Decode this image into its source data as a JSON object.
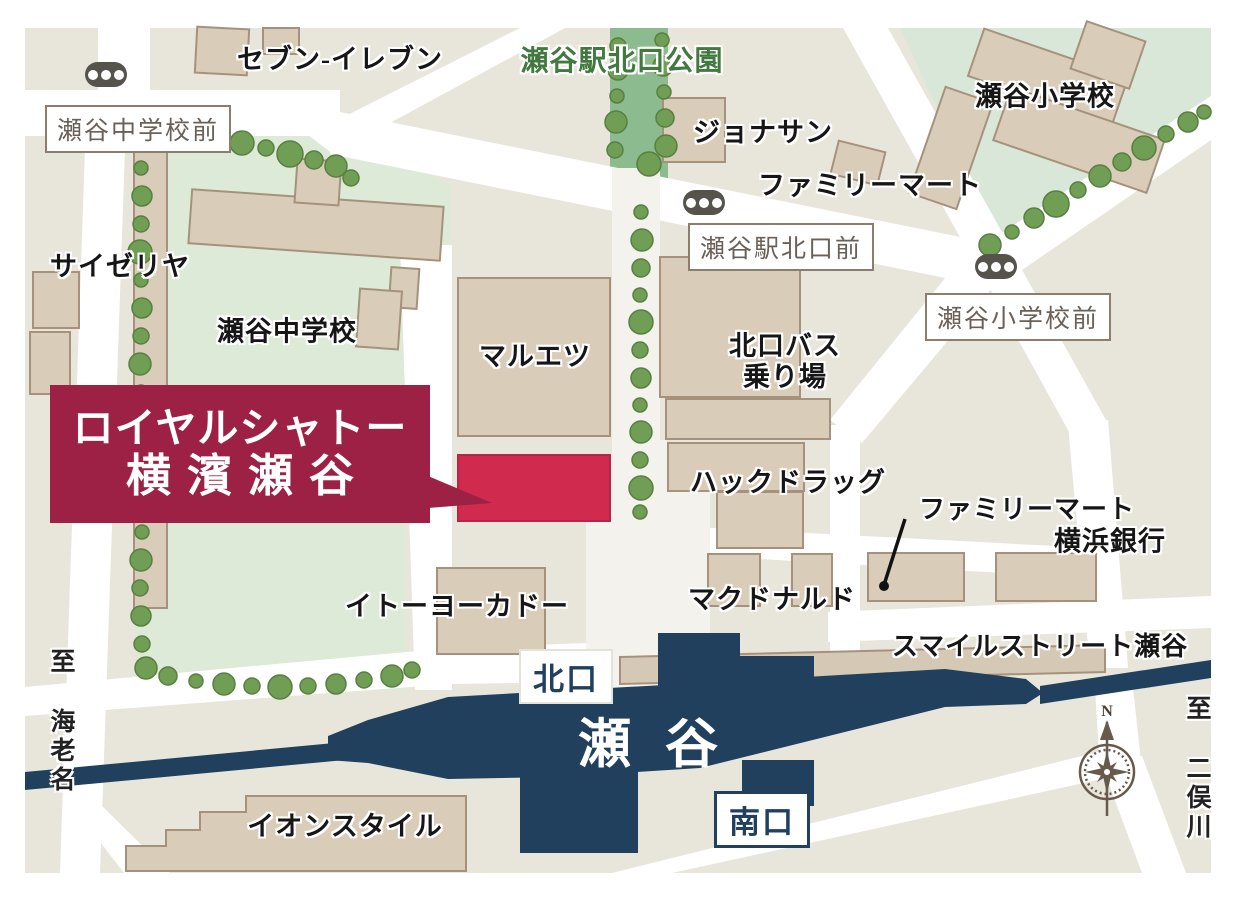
{
  "property_callout": {
    "line1": "ロイヤルシャトー",
    "line2": "横濱瀬谷"
  },
  "station": {
    "name": "瀬谷",
    "north_exit": "北口",
    "south_exit": "南口"
  },
  "labels": {
    "seven_eleven": "セブン-イレブン",
    "seya_north_park": "瀬谷駅北口公園",
    "jonathan": "ジョナサン",
    "familymart_north": "ファミリーマート",
    "seya_elementary": "瀬谷小学校",
    "saizeriya": "サイゼリヤ",
    "seya_junior_high": "瀬谷中学校",
    "maruetsu": "マルエツ",
    "bus_terminal_line1": "北口バス",
    "bus_terminal_line2": "乗り場",
    "hac_drug": "ハックドラッグ",
    "familymart_east": "ファミリーマート",
    "yokohama_bank": "横浜銀行",
    "mcdonalds": "マクドナルド",
    "smile_street": "スマイルストリート瀬谷",
    "ito_yokado": "イトーヨーカドー",
    "aeon_style": "イオンスタイル"
  },
  "bus_stops": {
    "chugakko_mae": "瀬谷中学校前",
    "ekikita_mae": "瀬谷駅北口前",
    "shogakko_mae": "瀬谷小学校前"
  },
  "directions": {
    "west": "至 海老名",
    "east": "至 二俣川"
  },
  "compass": {
    "north": "N"
  },
  "colors": {
    "station_navy": "#20405e",
    "property_red": "#d02b4e",
    "callout_maroon": "#9d2144",
    "park_band_green": "#8dbb90",
    "school_green": "#dcead7",
    "building_tan": "#d9cdba",
    "map_background": "#e8e6db",
    "park_label_green": "#41793f",
    "tree_green": "#6f9e54"
  }
}
